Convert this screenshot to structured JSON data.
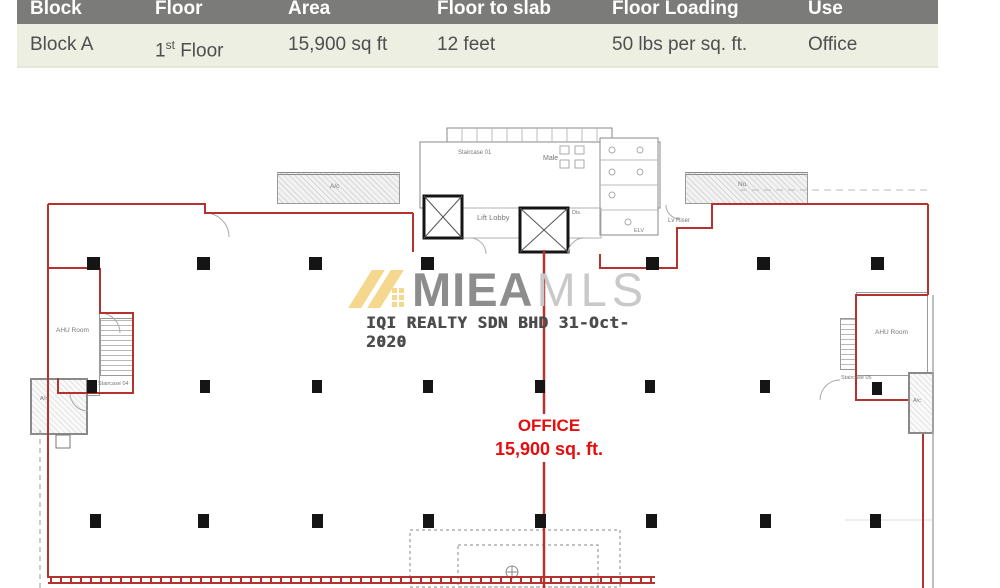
{
  "table": {
    "headers": {
      "block": "Block",
      "floor": "Floor",
      "area": "Area",
      "floor_to_slab": "Floor to slab",
      "floor_loading": "Floor Loading",
      "use": "Use"
    },
    "row": {
      "block": "Block A",
      "floor_num": "1",
      "floor_ord": "st",
      "floor_word": "Floor",
      "area": "15,900 sq ft",
      "floor_to_slab": "12 feet",
      "floor_loading": "50 lbs per sq. ft.",
      "use": "Office"
    }
  },
  "plan": {
    "office": {
      "title": "OFFICE",
      "area": "15,900 sq. ft."
    },
    "watermark": {
      "brand_primary": "MIEA",
      "brand_secondary": "MLS",
      "agency_line": "IQI REALTY SDN BHD 31-Oct-2020"
    },
    "rooms": {
      "staircase_01": "Staircase 01",
      "staircase_04": "Staircase 04",
      "staircase_05": "Staircase 05",
      "lift_lobby": "Lift Lobby",
      "male": "Male",
      "dis": "Dis.",
      "elv": "ELV",
      "lv_riser": "Lv Riser",
      "ahu_room_left": "AHU Room",
      "ahu_room_right": "AHU Room",
      "ac_ledge_left": "A/c",
      "ac_ledge_right_note": "No.",
      "ac_room_left": "A/c",
      "ac_room_right": "A/c"
    },
    "colors": {
      "boundary_red": "#b5332e",
      "office_text": "#e50d0d",
      "column_black": "#151515",
      "watermark_gold": "#f5d78d",
      "watermark_gray": "#8d8d8d",
      "watermark_light": "#c9c9c9",
      "table_header_bg": "#7b7b79",
      "table_row_bg": "#edefe3"
    }
  }
}
